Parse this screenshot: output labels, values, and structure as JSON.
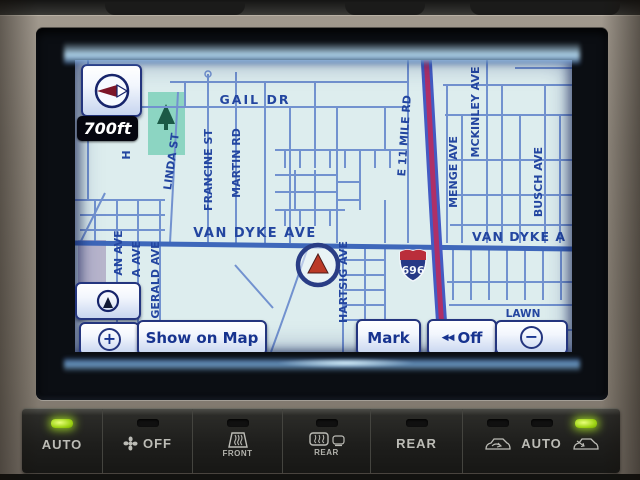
{
  "nav": {
    "scale": "700ft",
    "shield": "696",
    "buttons": {
      "zoom_in": "+",
      "zoom_out": "−",
      "show_on_map": "Show on Map",
      "mark": "Mark",
      "off": "Off",
      "off_icon": "◀◀"
    },
    "map": {
      "labels": {
        "gail_dr": "GAIL DR",
        "van_dyke_ave": "VAN DYKE AVE",
        "van_dyke_ave_right": "VAN DYKE A",
        "linda_st": "LINDA ST",
        "francine_st": "FRANCINE ST",
        "martin_rd": "MARTIN RD",
        "e_11_mile_rd": "E 11 MILE RD",
        "menge_ave": "MENGE AVE",
        "mckinley_ave": "MCKINLEY AVE",
        "busch_ave": "BUSCH AVE",
        "gerald_ave": "GERALD AVE",
        "an_ave": "AN AVE",
        "a_ave": "A AVE",
        "hartsig_ave": "HARTSIG AVE",
        "h_partial": "H",
        "lawn": "LAWN"
      }
    }
  },
  "climate": {
    "auto_left": "AUTO",
    "fan_off": "OFF",
    "front": "FRONT",
    "rear_defrost": "REAR",
    "rear": "REAR",
    "auto_right": "AUTO",
    "leds": {
      "auto_left_on": true,
      "auto_right_on": true
    }
  },
  "colors": {
    "map_background": "#e7f3f0",
    "minor_road": "#7291cf",
    "major_road": "#3a62b8",
    "highway_center": "#b5265e",
    "highway_edge": "#3f55c2",
    "park_green": "#8fd9c0",
    "label_blue": "#1d3e9c",
    "button_navy": "#24357e",
    "led_green": "#9fd416"
  }
}
